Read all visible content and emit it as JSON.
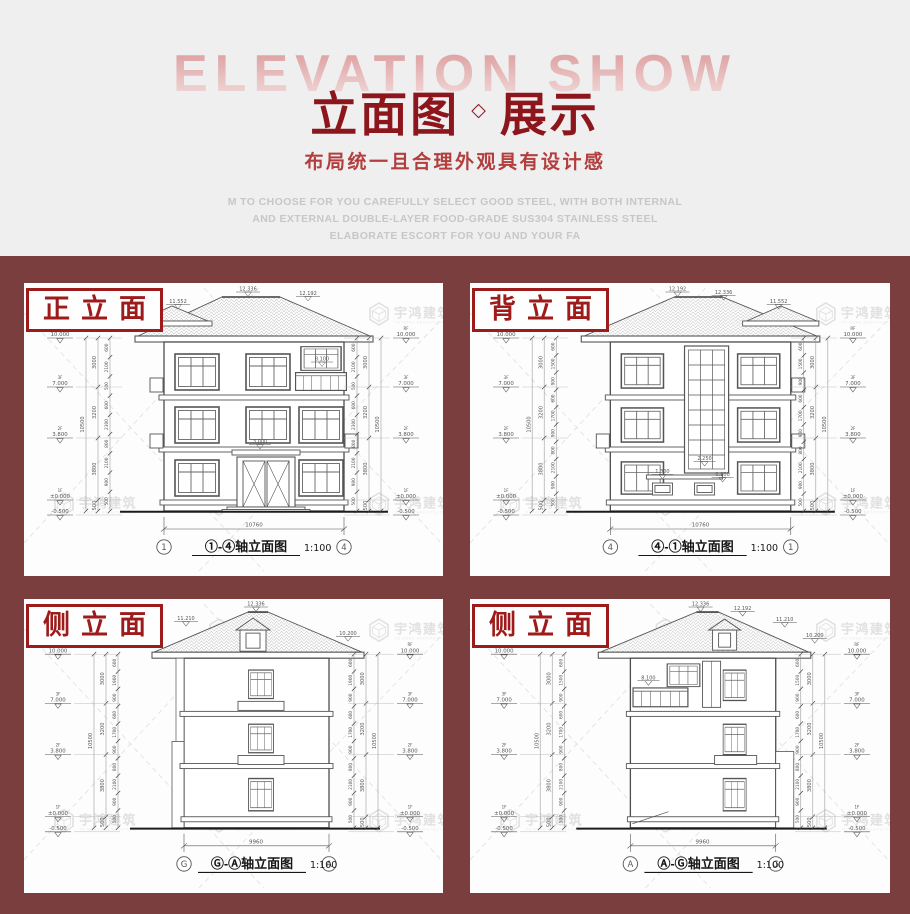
{
  "page": {
    "header_bg": "#efeff0",
    "board_bg": "#7b3e3e",
    "title_red": "#8c161c",
    "subtitle_red": "#b23f3e",
    "label_red": "#9e1b1b",
    "backdrop_pink": "#dfa2a2"
  },
  "header": {
    "backdrop_text": "ELEVATION SHOW",
    "title_main": "立面图",
    "title_sep": "◇",
    "title_tail": "展示",
    "subtitle": "布局统一且合理外观具有设计感",
    "desc_lines": [
      "M TO CHOOSE FOR YOU CAREFULLY SELECT GOOD STEEL, WITH BOTH INTERNAL",
      "AND EXTERNAL DOUBLE-LAYER FOOD-GRADE SUS304 STAINLESS STEEL",
      "ELABORATE ESCORT FOR YOU AND YOUR FA"
    ]
  },
  "watermark": {
    "name": "宇鸿建筑",
    "sub": "YU HONG ARCHITECTURE"
  },
  "panels": [
    {
      "tag": "正立面",
      "caption": "①-④轴立面图",
      "scale": "1:100",
      "axis_left": "1",
      "axis_right": "4",
      "bottom_dim": "10760",
      "roof_mark_left": "11.552",
      "roof_mark_center": "12.336",
      "roof_mark_right": "12.192",
      "balcony_mark": "8.100",
      "entry_mark": "3.000",
      "levels": [
        {
          "label": "RF",
          "value": "10.000"
        },
        {
          "label": "3F",
          "value": "7.000"
        },
        {
          "label": "2F",
          "value": "3.800"
        },
        {
          "label": "1F",
          "value": "±0.000"
        },
        {
          "label": "",
          "value": "-0.500"
        }
      ],
      "dims_inner": [
        "600",
        "2100",
        "500",
        "600",
        "2300",
        "800",
        "2100",
        "900",
        "500"
      ],
      "dims_floors": [
        "3000",
        "3200",
        "3800",
        "500"
      ],
      "dim_total": "10500"
    },
    {
      "tag": "背立面",
      "caption": "④-①轴立面图",
      "scale": "1:100",
      "axis_left": "4",
      "axis_right": "1",
      "bottom_dim": "10760",
      "roof_mark_left": "12.192",
      "roof_mark_center": "12.336",
      "roof_mark_right": "11.552",
      "stair_mark": "2.250",
      "vent_mark_left": "1.300",
      "vent_mark_right": "0.900",
      "levels": [
        {
          "label": "RF",
          "value": "10.000"
        },
        {
          "label": "3F",
          "value": "7.000"
        },
        {
          "label": "2F",
          "value": "3.800"
        },
        {
          "label": "1F",
          "value": "±0.000"
        },
        {
          "label": "",
          "value": "-0.500"
        }
      ],
      "dims_inner": [
        "600",
        "1500",
        "900",
        "600",
        "1700",
        "900",
        "800",
        "2100",
        "900",
        "500"
      ],
      "dims_floors": [
        "3000",
        "3200",
        "3800",
        "500"
      ],
      "dim_total": "10500"
    },
    {
      "tag": "侧立面",
      "caption": "Ⓖ-Ⓐ轴立面图",
      "scale": "1:100",
      "axis_left": "G",
      "axis_right": "A",
      "bottom_dim": "9960",
      "roof_mark_left": "11.210",
      "roof_mark_center": "12.336",
      "roof_mark_right": "10.200",
      "levels": [
        {
          "label": "RF",
          "value": "10.000"
        },
        {
          "label": "3F",
          "value": "7.000"
        },
        {
          "label": "2F",
          "value": "3.800"
        },
        {
          "label": "1F",
          "value": "±0.000"
        },
        {
          "label": "",
          "value": "-0.500"
        }
      ],
      "dims_inner": [
        "600",
        "1900",
        "900",
        "600",
        "1700",
        "900",
        "800",
        "2100",
        "900",
        "500"
      ],
      "dims_floors": [
        "3000",
        "3200",
        "3800",
        "500"
      ],
      "dim_total": "10500"
    },
    {
      "tag": "侧立面",
      "caption": "Ⓐ-Ⓖ轴立面图",
      "scale": "1:100",
      "axis_left": "A",
      "axis_right": "G",
      "bottom_dim": "9960",
      "roof_mark_center": "12.336",
      "roof_mark_center2": "12.192",
      "roof_mark_right": "11.210",
      "roof_mark_far_right": "10.200",
      "balcony_mark": "8.100",
      "levels": [
        {
          "label": "RF",
          "value": "10.000"
        },
        {
          "label": "3F",
          "value": "7.000"
        },
        {
          "label": "2F",
          "value": "3.800"
        },
        {
          "label": "1F",
          "value": "±0.000"
        },
        {
          "label": "",
          "value": "-0.500"
        }
      ],
      "dims_inner": [
        "600",
        "1500",
        "900",
        "600",
        "1700",
        "900",
        "800",
        "2100",
        "900",
        "500"
      ],
      "dims_floors": [
        "3000",
        "3200",
        "3800",
        "500"
      ],
      "dim_total": "10500"
    }
  ]
}
